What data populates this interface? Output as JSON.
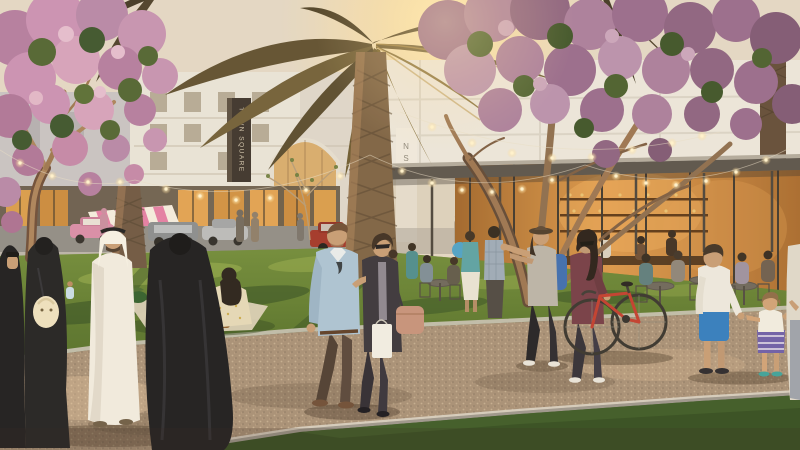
{
  "scene": {
    "description": "Dusk architectural rendering of a landscaped town-square park: families picnic on sunlit lawns beneath pink-blossom trees and date palms strung with festoon lights; a young couple strolls a gravel path past a glowing glass cafe pavilion; Emirati family in traditional dress, shoppers at a striped market awning, a woman wheeling a red bicycle, and children holding hands fill the plaza framed by white low-rise buildings."
  },
  "signs": {
    "banner": "TOWN SQUARE",
    "pillar": "NSH"
  },
  "palette": {
    "sky": "#d8cfc7",
    "sun_glow": "#ffe9b0",
    "building_white": "#e8e3da",
    "building_shadow": "#c6c2c4",
    "storefront_glow": "#d89a4a",
    "street": "#8d8a86",
    "awning_pink": "#e27ba4",
    "awning_cream": "#f4ece0",
    "lawn": "#5f7c30",
    "lawn_light": "#93a748",
    "lawn_dark": "#2f4a1e",
    "gravel": "#a58d76",
    "gravel_light": "#c9b294",
    "curb": "#c9c3b8",
    "palm_trunk": "#7a5f42",
    "frond_olive": "#6e5c36",
    "frond_gold": "#b8954e",
    "blossom_pink": "#c98fb4",
    "blossom_purple": "#96688c",
    "foliage_green": "#4a5e2c",
    "branch": "#a9805a",
    "glass_amber": "#c87f35",
    "roof": "#57504a",
    "bulb": "#fff3cf",
    "bike_red": "#c03a2c",
    "kandura_white": "#f0ebe1",
    "abaya_black": "#17171b",
    "shirt_blue": "#a9c2d6",
    "sweater_maroon": "#713844",
    "shorts_blue": "#2e7ac0",
    "skin": "#c59a74",
    "banner_dark": "#39302a",
    "blanket": "#ddd2bd",
    "basket": "#8a5a28",
    "bag_cream": "#ede0c0",
    "bag_tan": "#c4907a",
    "bag_white": "#f0ede6",
    "balloon_blue": "#4aa0c8"
  }
}
